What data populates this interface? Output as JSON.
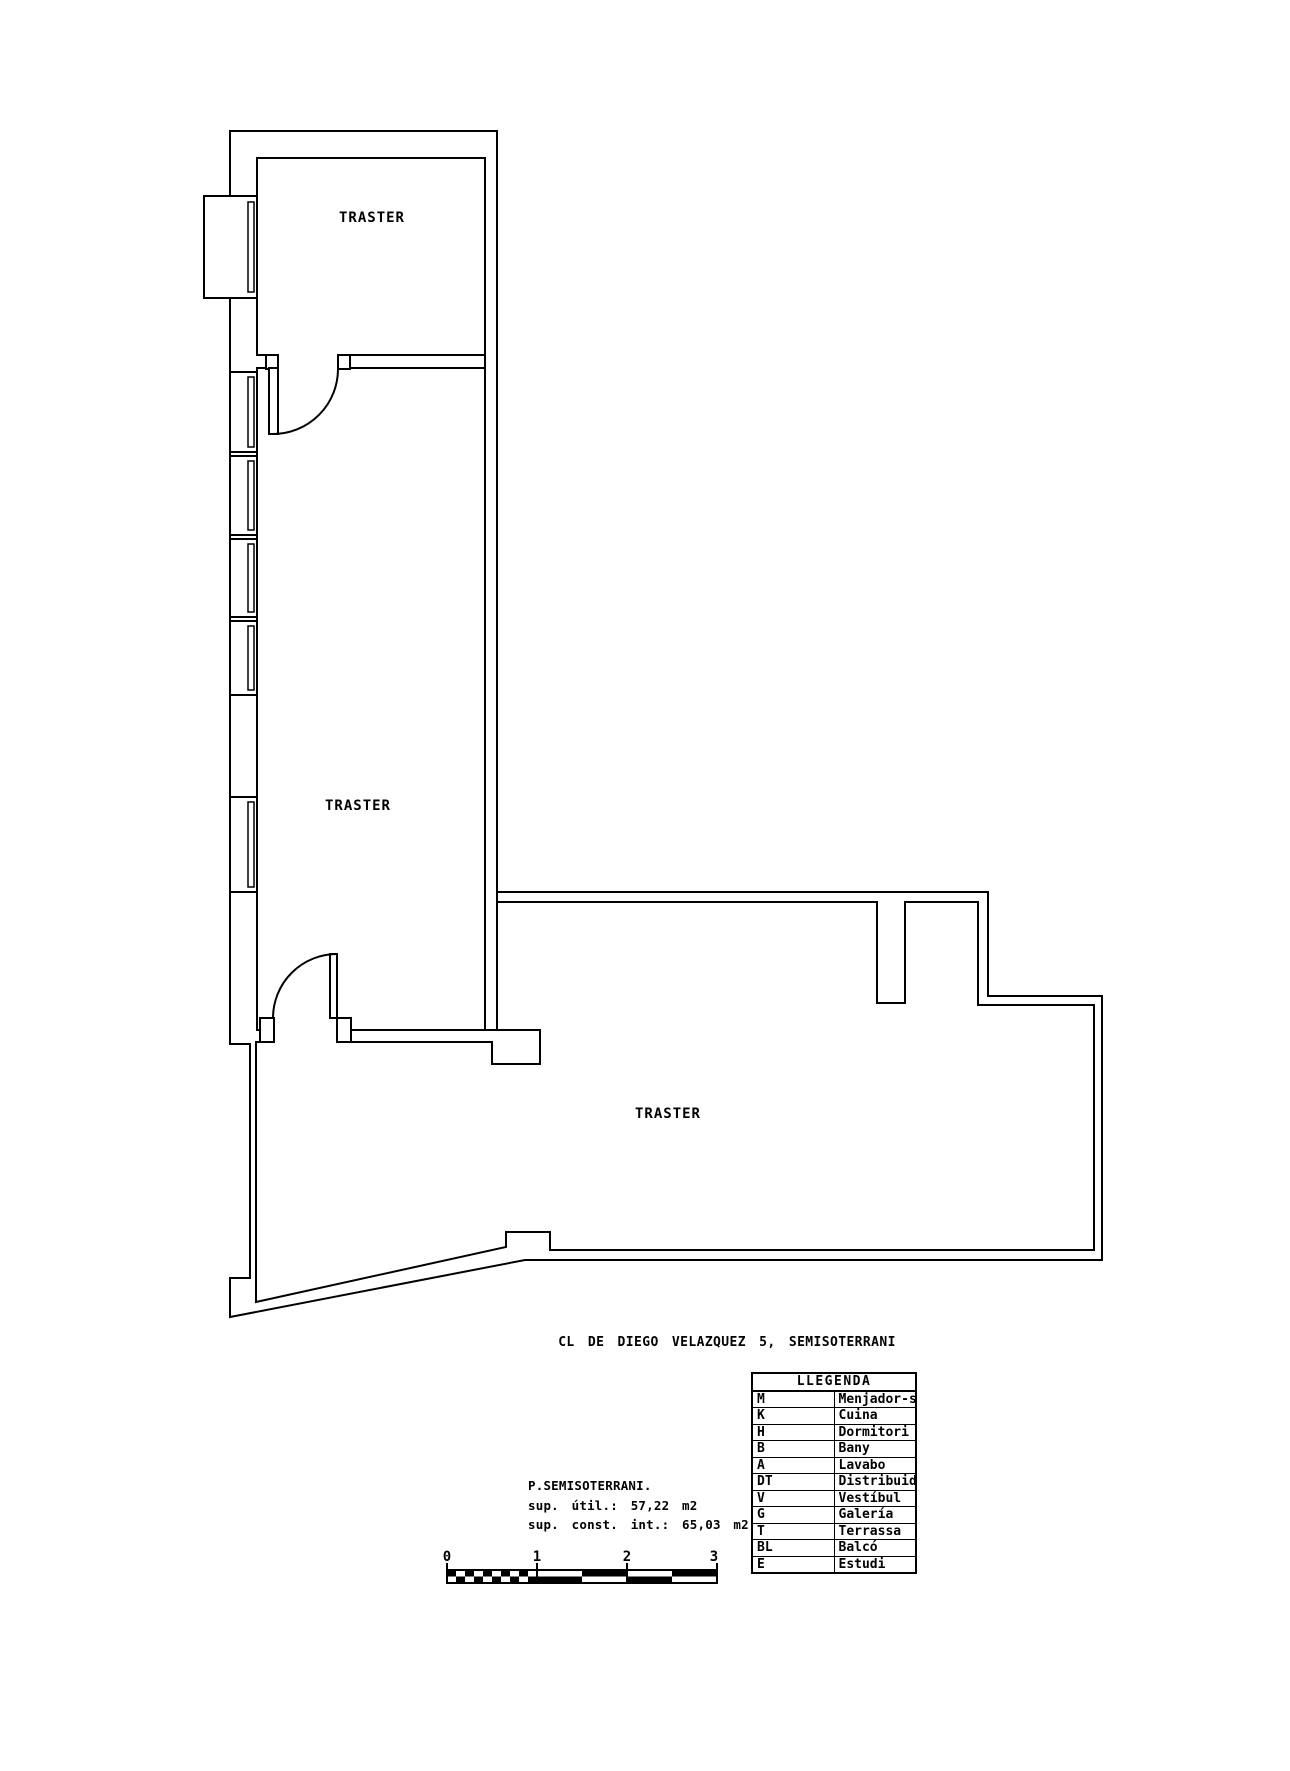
{
  "colors": {
    "ink": "#000000",
    "background": "#ffffff"
  },
  "rooms": {
    "traster1": "TRASTER",
    "traster2": "TRASTER",
    "traster3": "TRASTER"
  },
  "title": "CL DE DIEGO VELAZQUEZ 5, SEMISOTERRANI",
  "info": {
    "floor": "P.SEMISOTERRANI.",
    "useful": "sup. útil.: 57,22 m2",
    "built": "sup. const. int.: 65,03 m2"
  },
  "scale": {
    "labels": [
      "0",
      "1",
      "2",
      "3"
    ]
  },
  "legend": {
    "header": "LLEGENDA",
    "rows": [
      {
        "code": "M",
        "name": "Menjador-sala"
      },
      {
        "code": "K",
        "name": "Cuina"
      },
      {
        "code": "H",
        "name": "Dormitori"
      },
      {
        "code": "B",
        "name": "Bany"
      },
      {
        "code": "A",
        "name": "Lavabo"
      },
      {
        "code": "DT",
        "name": "Distribuidor"
      },
      {
        "code": "V",
        "name": "Vestíbul"
      },
      {
        "code": "G",
        "name": "Galería"
      },
      {
        "code": "T",
        "name": "Terrassa"
      },
      {
        "code": "BL",
        "name": "Balcó"
      },
      {
        "code": "E",
        "name": "Estudi"
      }
    ]
  }
}
